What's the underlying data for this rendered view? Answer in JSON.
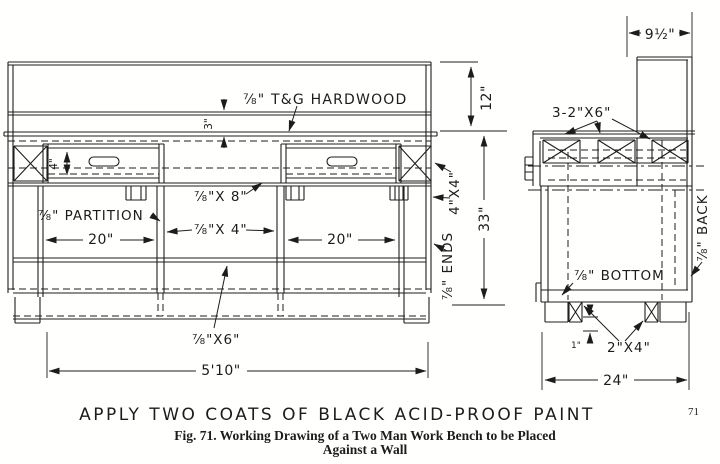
{
  "drawing": {
    "front_view": {
      "top_label": "⅞\" T&G HARDWOOD",
      "top_thickness": "3\"",
      "drawer_height": "4\"",
      "partition_label": "⅞\" PARTITION",
      "apron_label": "⅞\"X 8\"",
      "rail_label": "⅞\"X 4\"",
      "left_bay_width": "20\"",
      "right_bay_width": "20\"",
      "leg_label": "4\"X4\"",
      "ends_label": "⅞\" ENDS",
      "upper_height": "12\"",
      "lower_height": "33\"",
      "bottom_rail_label": "⅞\"X6\"",
      "overall_width": "5'10\""
    },
    "side_view": {
      "back_board_width": "9½\"",
      "top_supports_label": "3-2\"X6\"",
      "bottom_label": "⅞\" BOTTOM",
      "back_label": "⅞\" BACK",
      "foot_cleat_label": "2\"X4\"",
      "cleat_offset": "1\"",
      "overall_depth": "24\""
    }
  },
  "footer": {
    "paint_note": "APPLY  TWO  COATS  OF  BLACK  ACID-PROOF  PAINT",
    "page_number": "71",
    "caption_line1": "Fig. 71.   Working Drawing of a Two Man Work Bench to be Placed",
    "caption_line2": "Against a Wall"
  }
}
